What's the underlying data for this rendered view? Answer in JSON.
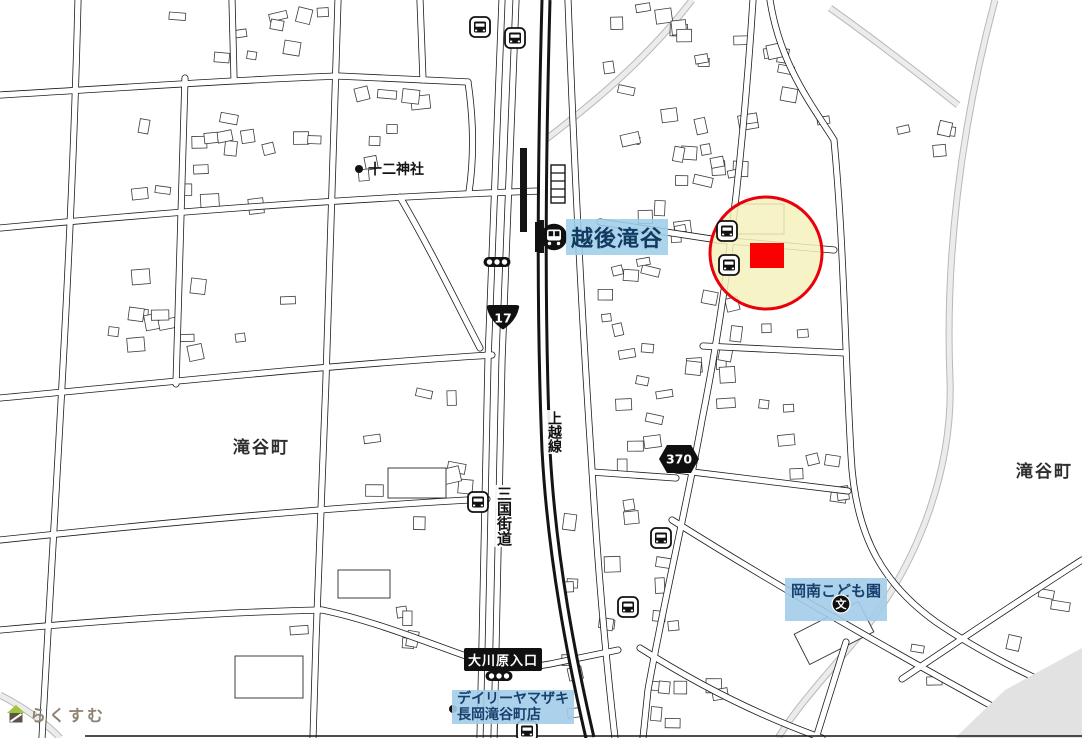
{
  "app": {
    "watermark_text": "らくすむ"
  },
  "station": {
    "name": "越後滝谷"
  },
  "railway": {
    "name": "上越線"
  },
  "road_names": {
    "historic": "三国街道"
  },
  "labels": {
    "town_left": "滝谷町",
    "town_right": "滝谷町",
    "shrine": "十二神社",
    "kindergarten": "岡南こども園",
    "school_icon_char": "文",
    "store_line1": "デイリーヤマザキ",
    "store_line2": "長岡滝谷町店",
    "bus_intersection": "大川原入口"
  },
  "shields": [
    {
      "number": "17",
      "type": "national",
      "x": 503,
      "y": 318
    },
    {
      "number": "370",
      "type": "prefectural",
      "x": 679,
      "y": 459
    }
  ],
  "markers": {
    "bus_stops": [
      [
        480,
        27
      ],
      [
        515,
        38
      ],
      [
        727,
        231
      ],
      [
        729,
        265
      ],
      [
        478,
        502
      ],
      [
        661,
        538
      ],
      [
        628,
        607
      ],
      [
        527,
        731
      ]
    ],
    "signals": [
      [
        497,
        262
      ],
      [
        499,
        676
      ]
    ],
    "poi_dots": [
      [
        359,
        169
      ],
      [
        453,
        709
      ]
    ]
  },
  "highlight": {
    "circle": {
      "cx": 766,
      "cy": 253,
      "r": 56,
      "fill": "#f5f1bd",
      "fill_opacity": 0.85,
      "stroke": "#e8000d",
      "stroke_width": 3
    },
    "rect": {
      "x": 750,
      "y": 243,
      "w": 34,
      "h": 25,
      "fill": "#fb0000"
    }
  },
  "colors": {
    "label_bg_blue": "#a3cde9",
    "label_text_blue": "#17406e",
    "shield_fill": "#101010",
    "road_line": "#1c1c1c",
    "gray_road": "#c9c9c9",
    "building_line": "#3c3c3c"
  }
}
